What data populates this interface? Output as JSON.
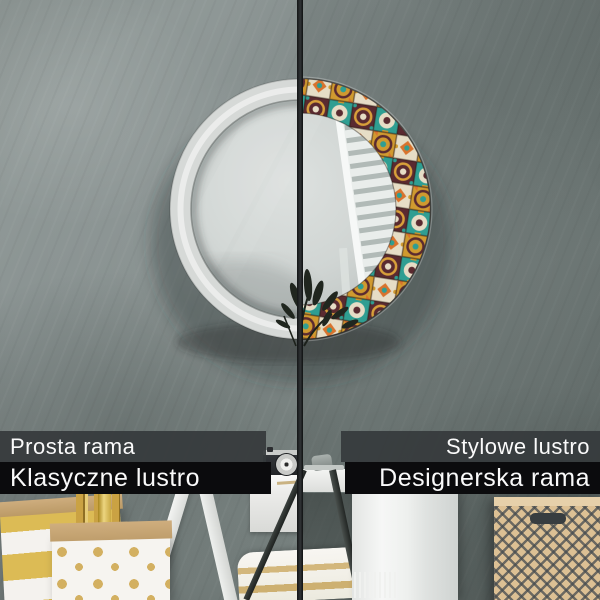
{
  "image": {
    "type": "product-comparison-photo",
    "subject": "round wall mirror shown half with a plain frame and half with a decorative patchwork-tile frame"
  },
  "split_view": {
    "left": {
      "line1": "Prosta rama",
      "line2": "Klasyczne lustro"
    },
    "right": {
      "line1": "Stylowe lustro",
      "line2": "Designerska rama"
    }
  },
  "colors": {
    "label_bar_top": "#3a3e41",
    "label_bar_bottom": "#0b0b0d",
    "label_text": "#fafafa",
    "plain_frame": "#d6d9d7",
    "wall_left": "#8d9695",
    "wall_right": "#76807e",
    "divider": "#1b1d1e",
    "tile_teal": "#2f9e92",
    "tile_maroon": "#5a2a30",
    "tile_gold": "#d09a2f",
    "tile_orange": "#d8732d",
    "tile_cream": "#e6ddc6",
    "gold_accent": "#c9a843"
  }
}
